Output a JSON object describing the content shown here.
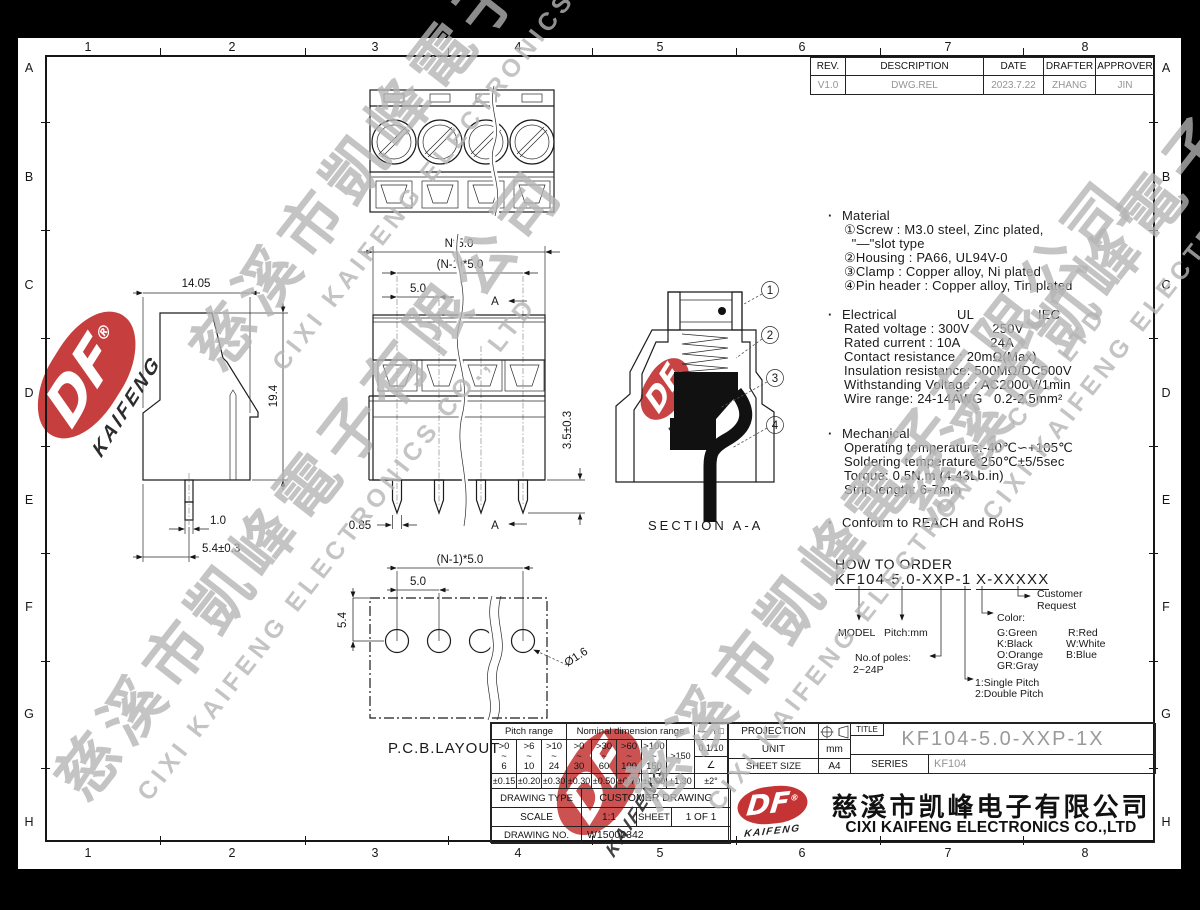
{
  "grid": {
    "cols": [
      "1",
      "2",
      "3",
      "4",
      "5",
      "6",
      "7",
      "8"
    ],
    "rows": [
      "A",
      "B",
      "C",
      "D",
      "E",
      "F",
      "G",
      "H"
    ]
  },
  "revision_table": {
    "headers": [
      "REV.",
      "DESCRIPTION",
      "DATE",
      "DRAFTER",
      "APPROVER"
    ],
    "row": {
      "rev": "V1.0",
      "description": "DWG.REL",
      "date": "2023.7.22",
      "drafter": "ZHANG",
      "approver": "JIN"
    }
  },
  "views": {
    "front": {
      "dim_overall": "N*5.0",
      "dim_span": "(N-1)*5.0",
      "dim_pitch": "5.0",
      "dim_pin_length": "3.5±0.3",
      "dim_pin_width": "0.85",
      "section_mark": "A"
    },
    "side": {
      "dim_depth": "14.05",
      "dim_height": "19.4",
      "dim_pin_width": "1.0",
      "dim_pin_offset": "5.4±0.3"
    },
    "section": {
      "label": "SECTION A-A",
      "callout_1": "1",
      "callout_2": "2",
      "callout_3": "3",
      "callout_4": "4"
    },
    "pcb": {
      "label": "P.C.B.LAYOUT",
      "dim_span": "(N-1)*5.0",
      "dim_pitch": "5.0",
      "dim_row": "5.4",
      "dim_hole": "Ø1.6"
    }
  },
  "specs": {
    "bullet": "·",
    "material_title": "Material",
    "material_lines": [
      "①Screw : M3.0 steel, Zinc plated,",
      "  \"—\"slot type",
      "②Housing : PA66, UL94V-0",
      "③Clamp : Copper alloy, Ni plated",
      "④Pin header : Copper alloy, Tin plated"
    ],
    "electrical_title": "Electrical",
    "electrical_col_ul": "UL",
    "electrical_col_iec": "IEC",
    "electrical_lines": [
      "Rated voltage : 300V      250V",
      "Rated current : 10A        24A",
      "Contact resistance : 20mΩ(Max)",
      "Insulation resistance: 500MΩ/DC500V",
      "Withstanding Voltage : AC2000V/1min",
      "Wire range: 24-14AWG   0.2-2.5mm²"
    ],
    "mechanical_title": "Mechanical",
    "mechanical_lines": [
      "Operating temperature:-40℃∽+105℃",
      "Soldering temperature:250℃±5/5sec",
      "Torque: 0.5N.m (4.43Lb.in)",
      "Strip length: 6-7mm"
    ],
    "conform_line": "Conform to REACH and RoHS"
  },
  "order": {
    "title": "HOW TO ORDER",
    "code_main": "KF104-5.0-XXP-1",
    "code_suffix": "X-XXXXX",
    "model_label": "MODEL",
    "pitch_label": "Pitch:mm",
    "poles_label": "No.of poles:",
    "poles_range": "2~24P",
    "color_label": "Color:",
    "color_col1": [
      "G:Green",
      "K:Black",
      "O:Orange",
      "GR:Gray"
    ],
    "color_col2": [
      "R:Red",
      "W:White",
      "B:Blue"
    ],
    "pitch_opt1": "1:Single Pitch",
    "pitch_opt2": "2:Double Pitch",
    "customer_line1": "Customer",
    "customer_line2": "Request"
  },
  "tolerance": {
    "pitch_header": "Pitch range",
    "nominal_header": "Nominal dimension range",
    "pitch_ranges": [
      ">0\n~\n6",
      ">6\n~\n10",
      ">10\n~\n24"
    ],
    "nominal_ranges": [
      ">0\n~\n30",
      ">30\n~\n60",
      ">60\n~\n100",
      ">100\n~\n150"
    ],
    "over_range": ">150",
    "pitch_tols": [
      "±0.15",
      "±0.20",
      "±0.30"
    ],
    "nominal_tols": [
      "±0.30",
      "±0.50",
      "±0.70",
      "±1.00",
      "±1.30"
    ],
    "sym_header": "— ∩ □",
    "sym_flat": "0.1/10",
    "sym_angle": "∠",
    "sym_angle_tol": "±2°"
  },
  "titleblock": {
    "projection_label": "PROJECTION",
    "unit_label": "UNIT",
    "unit_value": "mm",
    "sheet_size_label": "SHEET SIZE",
    "sheet_size_value": "A4",
    "title_label": "TITLE",
    "title_value": "KF104-5.0-XXP-1X",
    "series_label": "SERIES",
    "series_value": "KF104",
    "drawing_type_label": "DRAWING TYPE",
    "drawing_type_value": "CUSTOMER DRAWING",
    "scale_label": "SCALE",
    "scale_value": "1:1",
    "sheet_label": "SHEET",
    "sheet_value": "1 OF 1",
    "drawing_no_label": "DRAWING NO.",
    "drawing_no_value": "W15000342"
  },
  "company": {
    "logo_text": "DF",
    "logo_sub": "KAIFENG",
    "reg_mark": "®",
    "name_cn": "慈溪市凯峰电子有限公司",
    "name_en": "CIXI KAIFENG ELECTRONICS CO.,LTD"
  },
  "watermark": {
    "cn": "慈溪市凱峰電子有限公司",
    "en": "CIXI KAIFENG ELECTRONICS CO., LTD",
    "logo_text": "DF",
    "logo_sub": "KAIFENG"
  },
  "colors": {
    "logo_red": "#c43434",
    "watermark_gray": "#b4b4b4",
    "title_gray": "#9a9a9a",
    "line_dark": "#1a1a1a"
  }
}
